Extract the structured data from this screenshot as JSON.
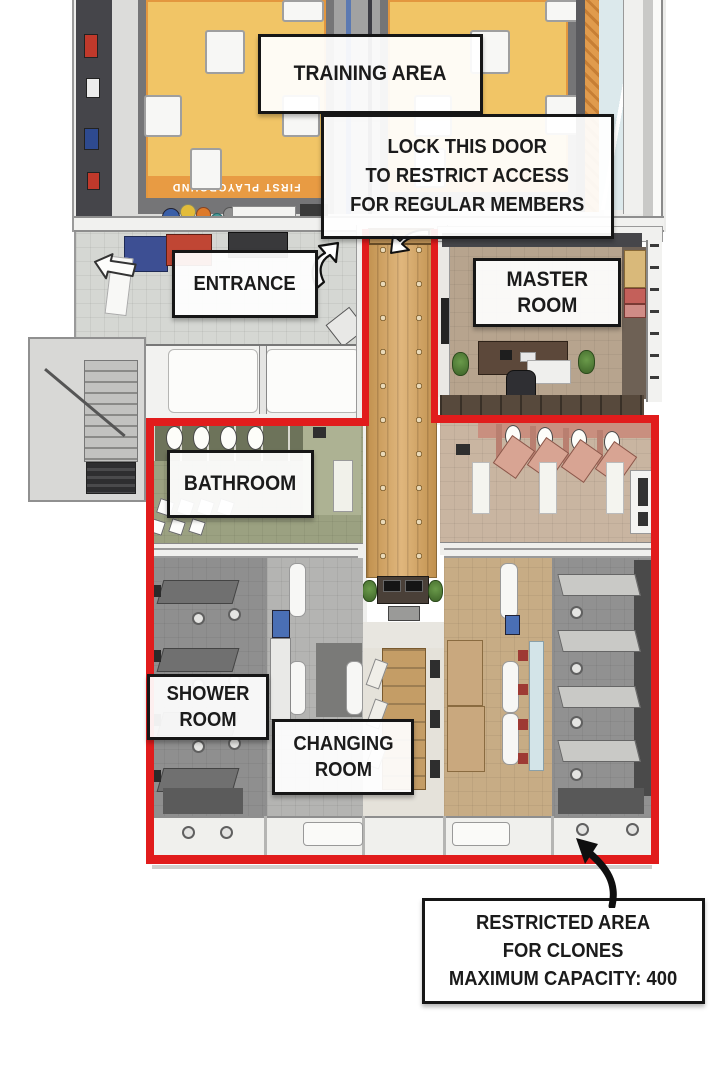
{
  "page": {
    "title": "Gym floor plan with restricted clone area"
  },
  "callouts": {
    "training_area": {
      "lines": [
        "TRAINING AREA"
      ]
    },
    "lock_door": {
      "lines": [
        "LOCK THIS DOOR",
        "TO RESTRICT ACCESS",
        "FOR REGULAR MEMBERS"
      ]
    },
    "entrance": {
      "lines": [
        "ENTRANCE"
      ]
    },
    "master_room": {
      "lines": [
        "MASTER",
        "ROOM"
      ]
    },
    "bathroom": {
      "lines": [
        "BATHROOM"
      ]
    },
    "shower_room": {
      "lines": [
        "SHOWER",
        "ROOM"
      ]
    },
    "changing_room": {
      "lines": [
        "CHANGING",
        "ROOM"
      ]
    },
    "restricted_area": {
      "lines": [
        "RESTRICTED AREA",
        "FOR CLONES",
        "MAXIMUM CAPACITY: 400"
      ]
    }
  },
  "floor_text": {
    "mat_banner": "FIRST PLAYGROUND"
  },
  "colors": {
    "restricted_outline": "#e11c1c",
    "callout_border": "#161616",
    "mat_yellow": "#f1c566",
    "mat_band_orange": "#e89b43",
    "corridor_wood": "#d7a258"
  }
}
